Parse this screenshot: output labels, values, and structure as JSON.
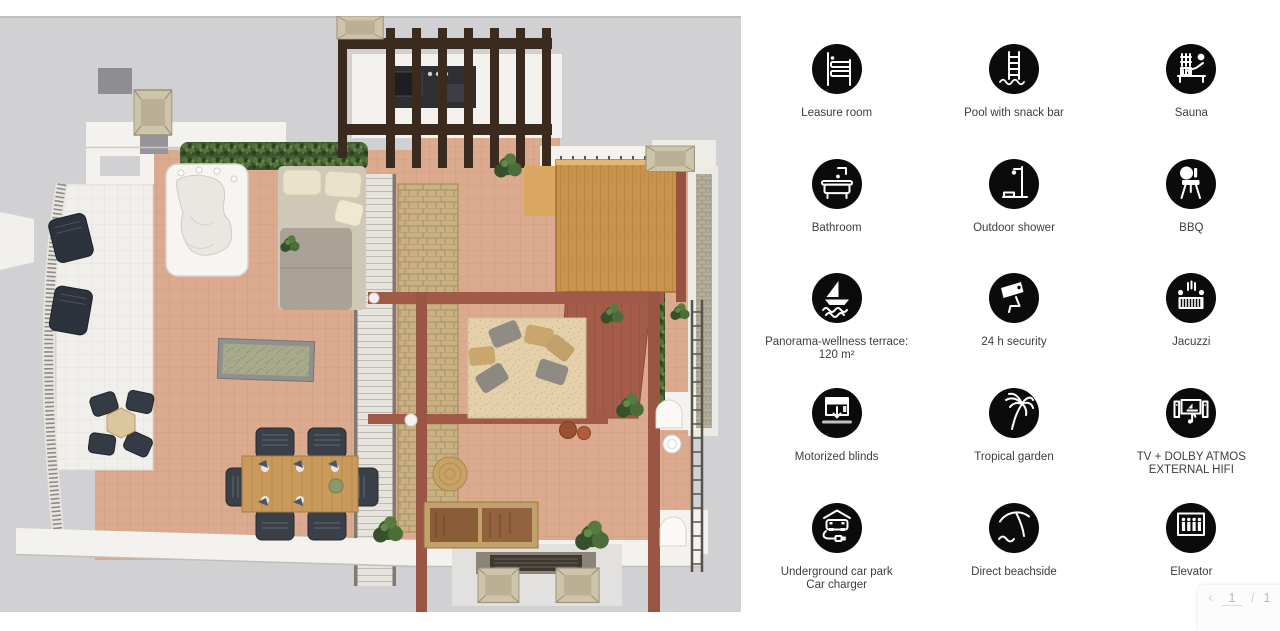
{
  "floor_plan": {
    "description": "3D top-down architectural rendering of a penthouse wellness terrace with hot tub, pergola with outdoor kitchen, wood deck, lounge rug with cushions, dining set, bistro set, stairs, balconies and planting",
    "background_color": "#d1d1d3",
    "colors": {
      "terracotta_tile": "#dcab8f",
      "wood_deck": "#c9934d",
      "pergola_wood": "#3b2a1e",
      "accent_beam": "#a05a48",
      "wall_white": "#f4f2ee",
      "hedge_green": "#3e5630"
    }
  },
  "amenities": [
    {
      "label": "Leasure room",
      "icon": "bed-icon"
    },
    {
      "label": "Pool with snack bar",
      "icon": "pool-ladder-icon"
    },
    {
      "label": "Sauna",
      "icon": "sauna-icon"
    },
    {
      "label": "Bathroom",
      "icon": "bathtub-icon"
    },
    {
      "label": "Outdoor shower",
      "icon": "outdoor-shower-icon"
    },
    {
      "label": "BBQ",
      "icon": "bbq-grill-icon"
    },
    {
      "label": "Panorama-wellness terrace:\n120 m²",
      "icon": "sailboat-icon"
    },
    {
      "label": "24 h security",
      "icon": "security-camera-icon"
    },
    {
      "label": "Jacuzzi",
      "icon": "jacuzzi-icon"
    },
    {
      "label": "Motorized blinds",
      "icon": "motorized-blinds-icon"
    },
    {
      "label": "Tropical garden",
      "icon": "palm-tree-icon"
    },
    {
      "label": "TV + DOLBY ATMOS\nEXTERNAL HIFI",
      "icon": "tv-hifi-icon"
    },
    {
      "label": "Underground car park\nCar charger",
      "icon": "car-charger-icon"
    },
    {
      "label": "Direct beachside",
      "icon": "beach-umbrella-icon"
    },
    {
      "label": "Elevator",
      "icon": "elevator-icon"
    }
  ],
  "pager": {
    "prev_label": "‹",
    "current_page": "1",
    "separator": "/",
    "total_pages": "1"
  }
}
